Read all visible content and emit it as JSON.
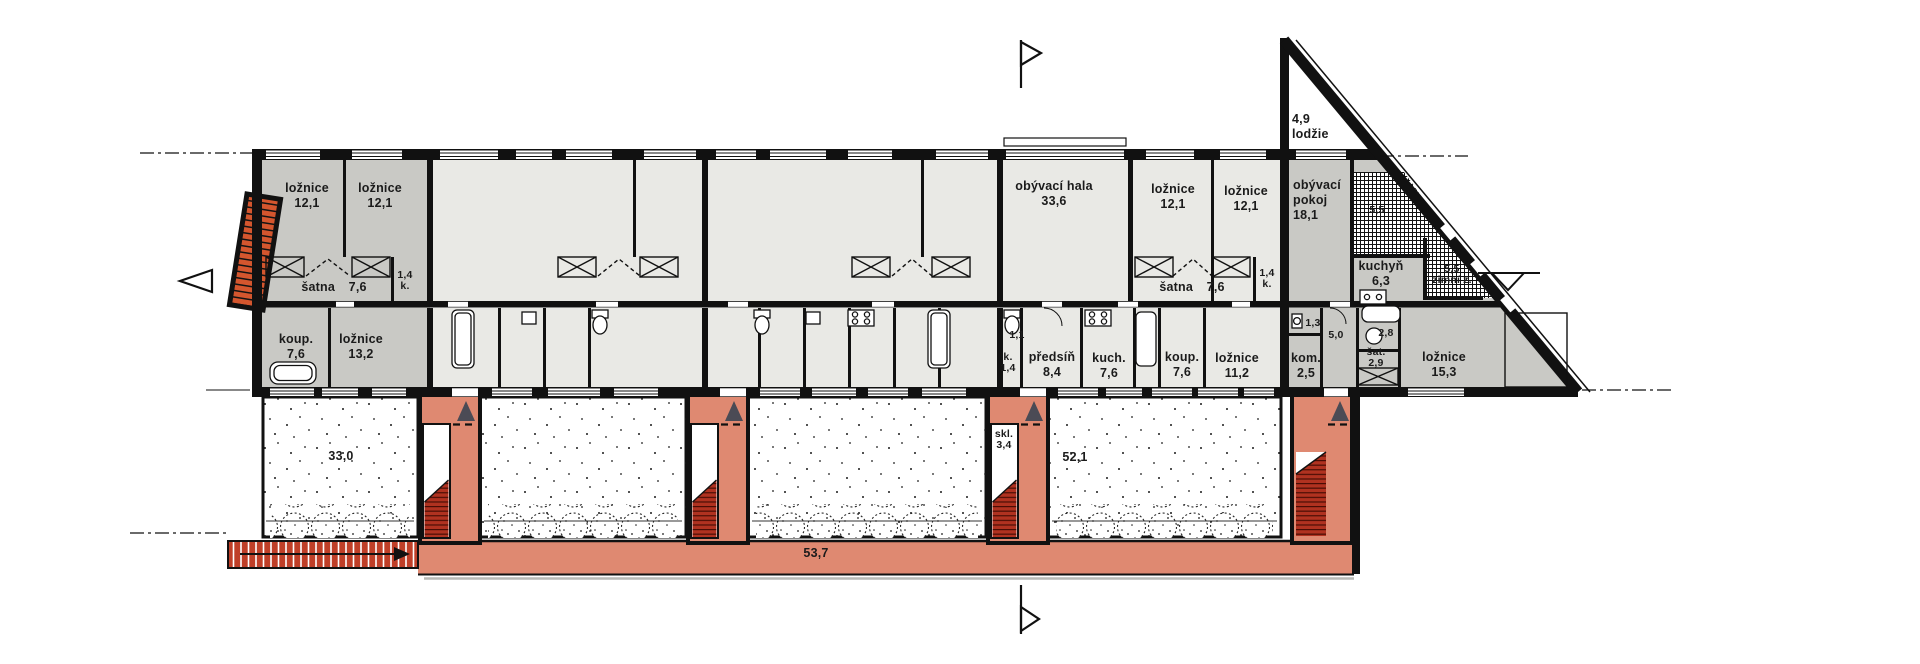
{
  "colors": {
    "walkway_salmon": "#df8971",
    "stair_tread_red": "#b03220",
    "exterior_stair_orange": "#d4562e",
    "ramp_brick_red": "#bf3f28",
    "room_gray_dark": "#c9c9c5",
    "room_gray_light": "#e9e9e5",
    "wall_black": "#111111",
    "entrance_arrow_gray": "#4b4b55"
  },
  "markers": {
    "section_line_top": "flag-marker",
    "section_line_bottom": "flag-marker",
    "level_marker_left": "open-triangle-marker",
    "level_marker_right": "open-triangle-marker",
    "entrance_arrows": "up-triangle-arrow",
    "ramp_arrow": "right-arrow"
  },
  "labels": {
    "bedroom_a": {
      "name": "ložnice",
      "area": "12,1"
    },
    "bedroom_b": {
      "name": "ložnice",
      "area": "12,1"
    },
    "wardrobe_left": {
      "name": "šatna",
      "area": "7,6"
    },
    "closet_left": {
      "area": "1,4",
      "abbr": "k."
    },
    "living_hall": {
      "name": "obývací hala",
      "area": "33,6"
    },
    "bedroom_c": {
      "name": "ložnice",
      "area": "12,1"
    },
    "bedroom_d": {
      "name": "ložnice",
      "area": "12,1"
    },
    "living_room": {
      "line1": "obývací",
      "line2": "pokoj",
      "area": "18,1"
    },
    "loggia": {
      "area": "4,9",
      "name": "lodžie"
    },
    "terrace_upper": {
      "area": "5,5"
    },
    "kitchen_right": {
      "name": "kuchyň",
      "area": "6,3"
    },
    "winter_garden": {
      "area": "5,5",
      "name": "zimní z."
    },
    "wardrobe_right": {
      "name": "šatna",
      "area": "7,6"
    },
    "closet_right": {
      "area": "1,4",
      "abbr": "k."
    },
    "bath_left": {
      "name": "koup.",
      "area": "7,6"
    },
    "bedroom_e": {
      "name": "ložnice",
      "area": "13,2"
    },
    "wc_mid": {
      "area": "1,1"
    },
    "closet_lower": {
      "abbr": "k.",
      "area": "1,4"
    },
    "hall_lower": {
      "name": "předsíň",
      "area": "8,4"
    },
    "kitchen_lower": {
      "name": "kuch.",
      "area": "7,6"
    },
    "bath_mid": {
      "name": "koup.",
      "area": "7,6"
    },
    "bedroom_f": {
      "name": "ložnice",
      "area": "11,2"
    },
    "chamber": {
      "name": "kom.",
      "area": "2,5"
    },
    "wc_right": {
      "area": "1,3"
    },
    "hall_right": {
      "area": "5,0"
    },
    "closet_28": {
      "area": "2,8"
    },
    "wardrobe_sat": {
      "name": "šat.",
      "area": "2,9"
    },
    "bedroom_g": {
      "name": "ložnice",
      "area": "15,3"
    },
    "garden_a": {
      "area": "33,0"
    },
    "storage": {
      "name": "skl.",
      "area": "3,4"
    },
    "garden_d": {
      "area": "52,1"
    },
    "walkway": {
      "area": "53,7"
    }
  }
}
